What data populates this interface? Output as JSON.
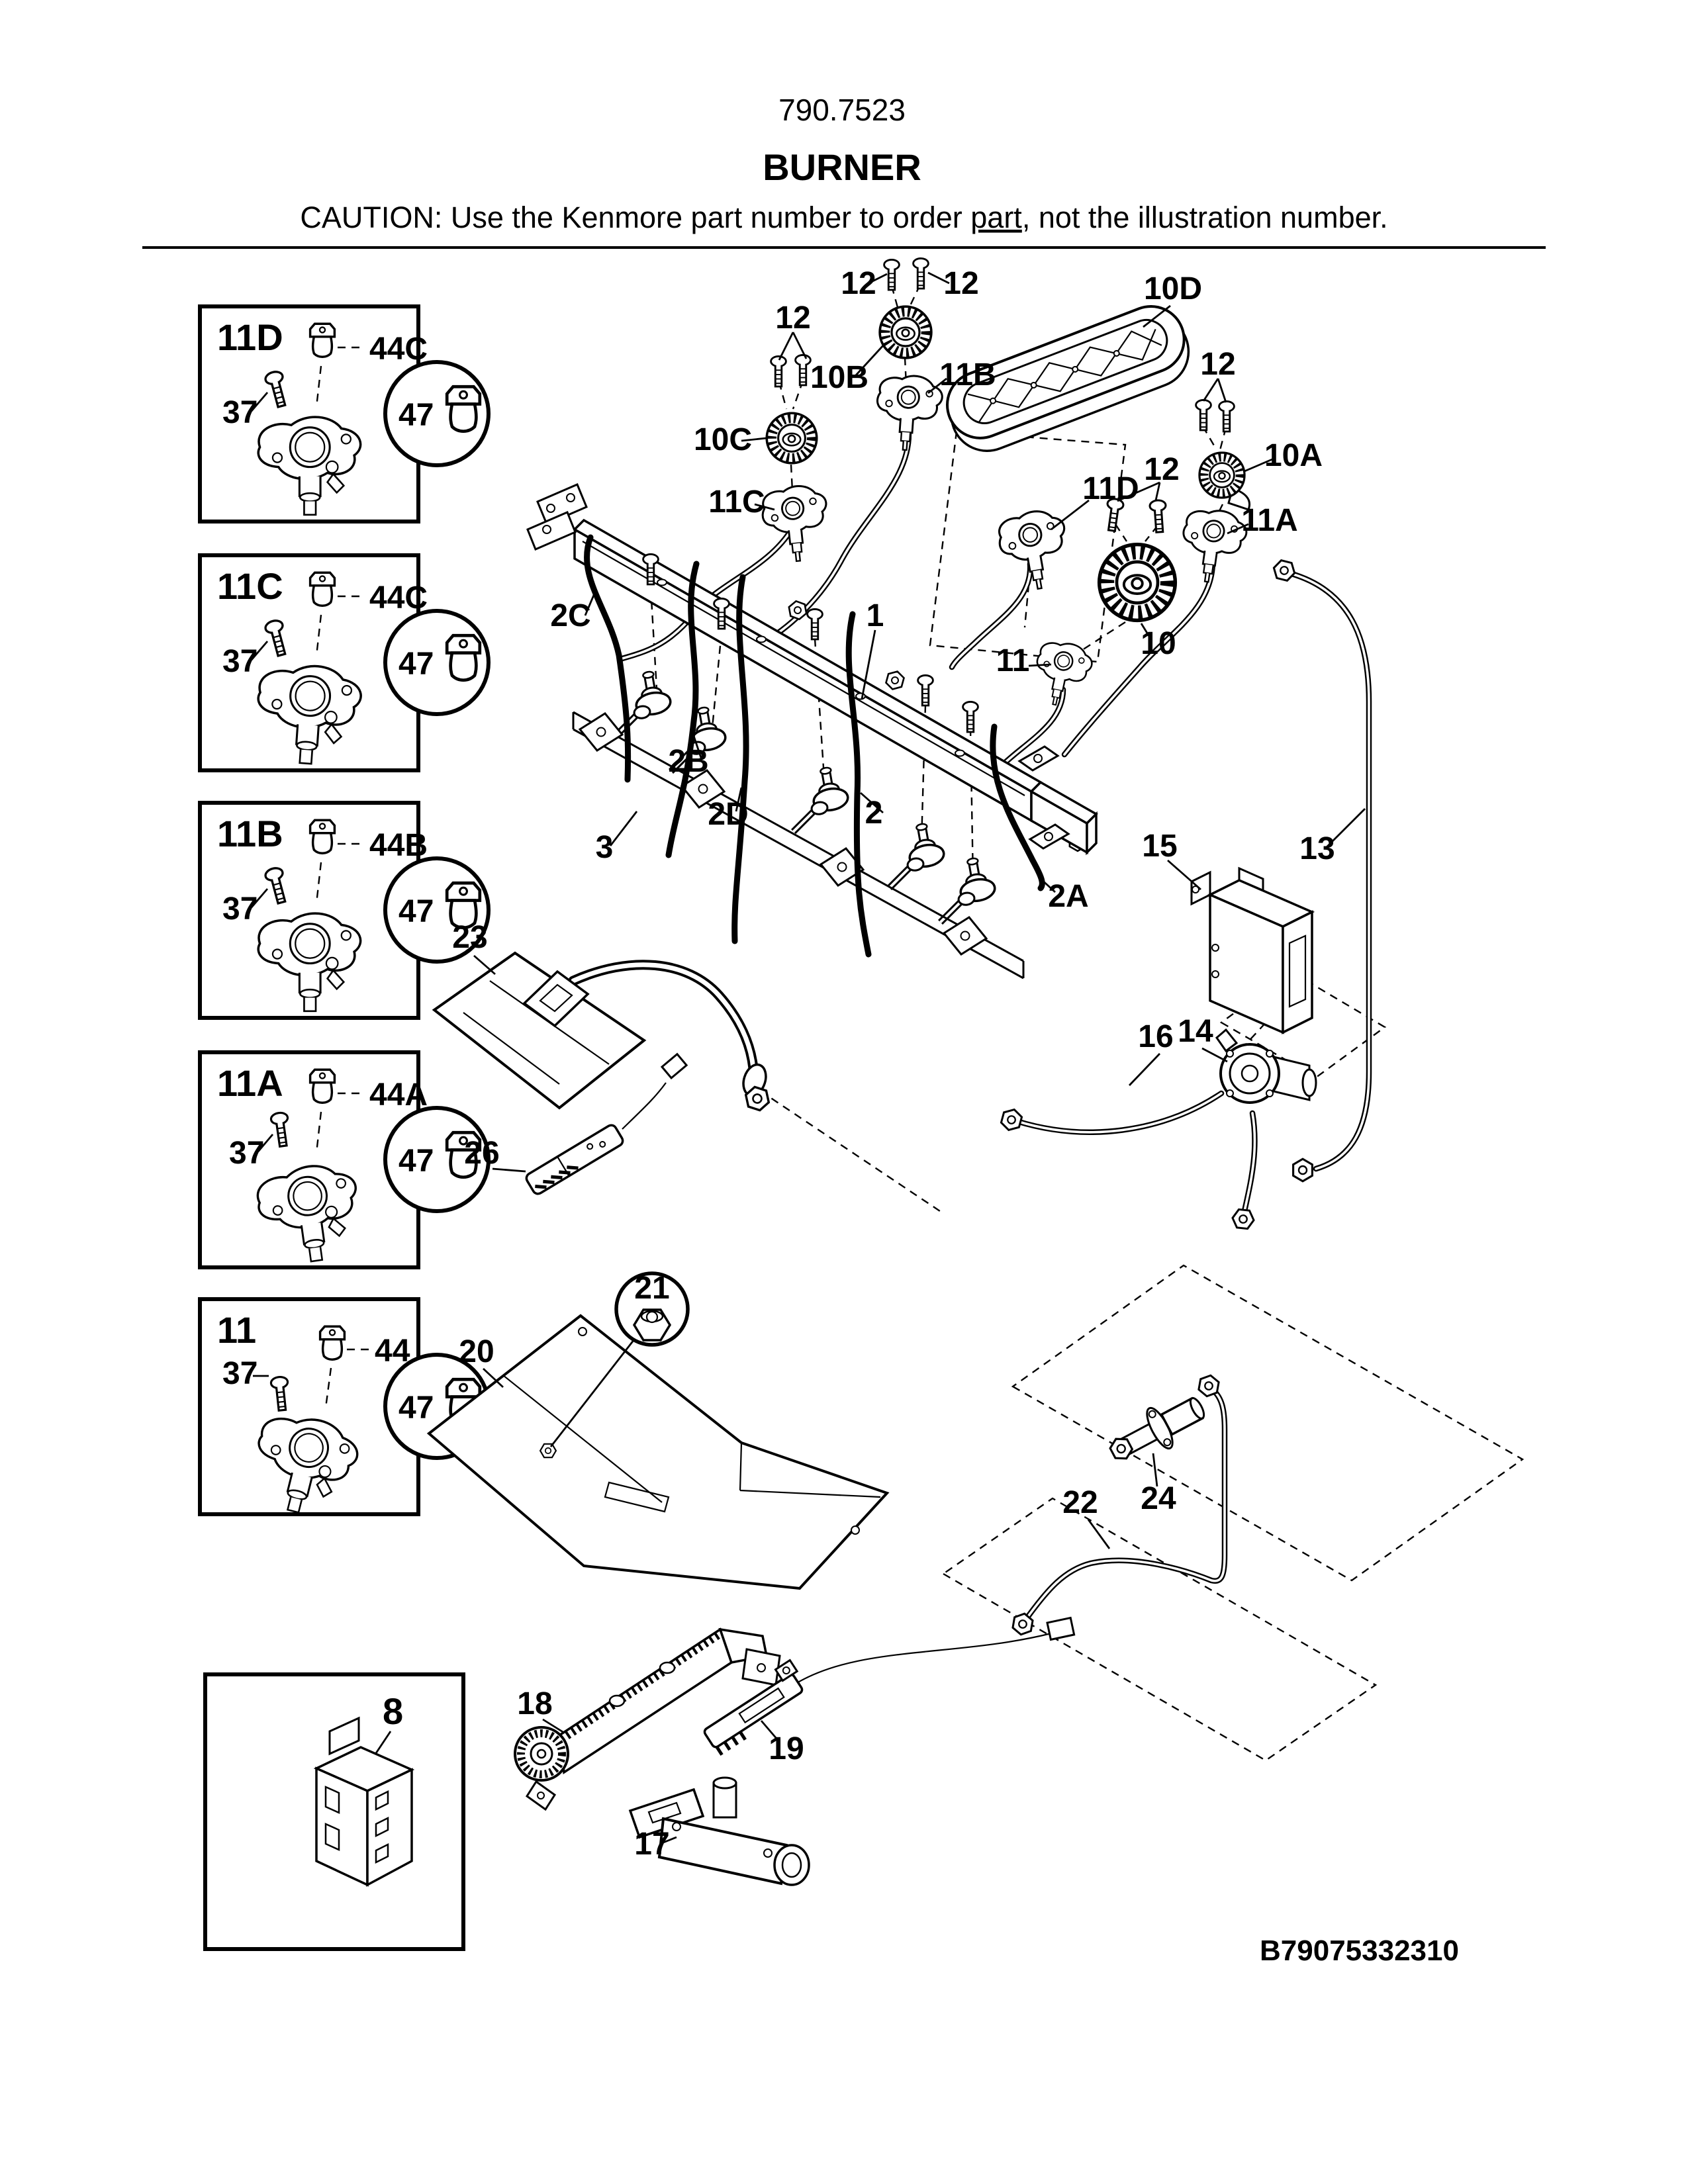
{
  "header": {
    "model": "790.7523",
    "title": "BURNER",
    "caution_prefix": "CAUTION: Use the Kenmore part number to order ",
    "caution_part": "part",
    "caution_suffix": ", not the illustration number."
  },
  "detail_boxes": [
    {
      "id": "11D",
      "screw": "37",
      "valve": "44C",
      "circle": "47"
    },
    {
      "id": "11C",
      "screw": "37",
      "valve": "44C",
      "circle": "47"
    },
    {
      "id": "11B",
      "screw": "37",
      "valve": "44B",
      "circle": "47"
    },
    {
      "id": "11A",
      "screw": "37",
      "valve": "44A",
      "circle": "47"
    },
    {
      "id": "11",
      "screw": "37",
      "valve": "44",
      "circle": "47"
    }
  ],
  "connector_box": {
    "id": "8"
  },
  "labels": {
    "screws_top_left": "12",
    "screws_top_right": "12",
    "screws_10c": "12",
    "screws_10a": "12",
    "screws_10": "12",
    "burner_10b": "10B",
    "burner_10c": "10C",
    "burner_10d": "10D",
    "burner_10a": "10A",
    "burner_10": "10",
    "holder_11b": "11B",
    "holder_11c": "11C",
    "holder_11d": "11D",
    "holder_11a": "11A",
    "holder_11": "11",
    "manifold_1": "1",
    "wire_2": "2",
    "wire_2a": "2A",
    "wire_2b": "2B",
    "wire_2c": "2C",
    "wire_2d": "2D",
    "rail_3": "3",
    "pipe_13": "13",
    "regulator_14": "14",
    "module_15": "15",
    "tube_16": "16",
    "valve_17": "17",
    "burner_18": "18",
    "igniter_19": "19",
    "panel_20": "20",
    "nut_21": "21",
    "tube_22": "22",
    "plate_23": "23",
    "orifice_24": "24",
    "igniter_26": "26"
  },
  "footer": {
    "code": "B79075332310"
  }
}
